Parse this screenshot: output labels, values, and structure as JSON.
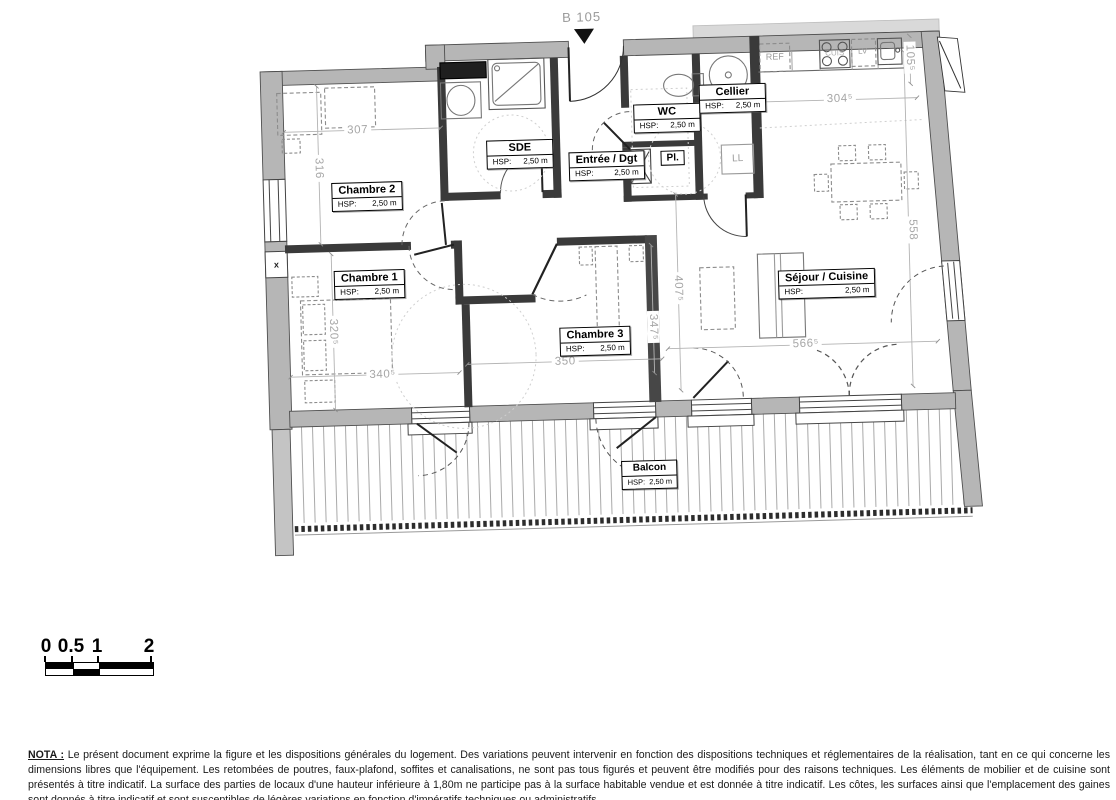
{
  "plan": {
    "unit_label": "B 105",
    "rooms": [
      {
        "name": "Chambre 2",
        "hsp_label": "HSP:",
        "hsp_value": "2,50 m"
      },
      {
        "name": "SDE",
        "hsp_label": "HSP:",
        "hsp_value": "2,50 m"
      },
      {
        "name": "Entrée / Dgt",
        "hsp_label": "HSP:",
        "hsp_value": "2,50 m"
      },
      {
        "name": "WC",
        "hsp_label": "HSP:",
        "hsp_value": "2,50 m"
      },
      {
        "name": "Cellier",
        "hsp_label": "HSP:",
        "hsp_value": "2,50 m"
      },
      {
        "name": "Chambre 1",
        "hsp_label": "HSP:",
        "hsp_value": "2,50 m"
      },
      {
        "name": "Chambre 3",
        "hsp_label": "HSP:",
        "hsp_value": "2,50 m"
      },
      {
        "name": "Séjour / Cuisine",
        "hsp_label": "HSP:",
        "hsp_value": "2,50 m"
      },
      {
        "name": "Balcon",
        "hsp_label": "HSP:",
        "hsp_value": "2,50 m"
      }
    ],
    "fixtures": {
      "fridge": "REF",
      "dishwasher": "LV",
      "washing_machine": "LL",
      "closet": "Pl.",
      "stove": "CUIS",
      "wall_mark": "x"
    },
    "dimensions_cm": [
      {
        "label": "307"
      },
      {
        "label": "316"
      },
      {
        "label": "304⁵"
      },
      {
        "label": "105⁵"
      },
      {
        "label": "558"
      },
      {
        "label": "320⁵"
      },
      {
        "label": "340⁵"
      },
      {
        "label": "350"
      },
      {
        "label": "347⁵"
      },
      {
        "label": "407⁵"
      },
      {
        "label": "566⁵"
      }
    ]
  },
  "scale_bar": {
    "ticks": [
      "0",
      "0.5",
      "1",
      "2"
    ]
  },
  "nota": {
    "heading": "NOTA :",
    "text": "Le présent document exprime la figure et les dispositions générales du logement. Des variations peuvent intervenir en fonction des dispositions techniques et réglementaires de la réalisation, tant en ce qui concerne les dimensions libres que l'équipement. Les retombées de poutres, faux-plafond, soffites et canalisations, ne sont pas tous figurés et peuvent être modifiés pour des raisons techniques. Les éléments de mobilier et de cuisine sont présentés à titre indicatif. La surface des parties de locaux d'une hauteur inférieure à 1,80m ne participe pas à la surface habitable vendue et est donnée à titre indicatif. Les côtes, les surfaces ainsi que l'emplacement des gaines sont donnés à titre indicatif et sont susceptibles de légères variations en fonction d'impératifs techniques ou administratifs."
  }
}
